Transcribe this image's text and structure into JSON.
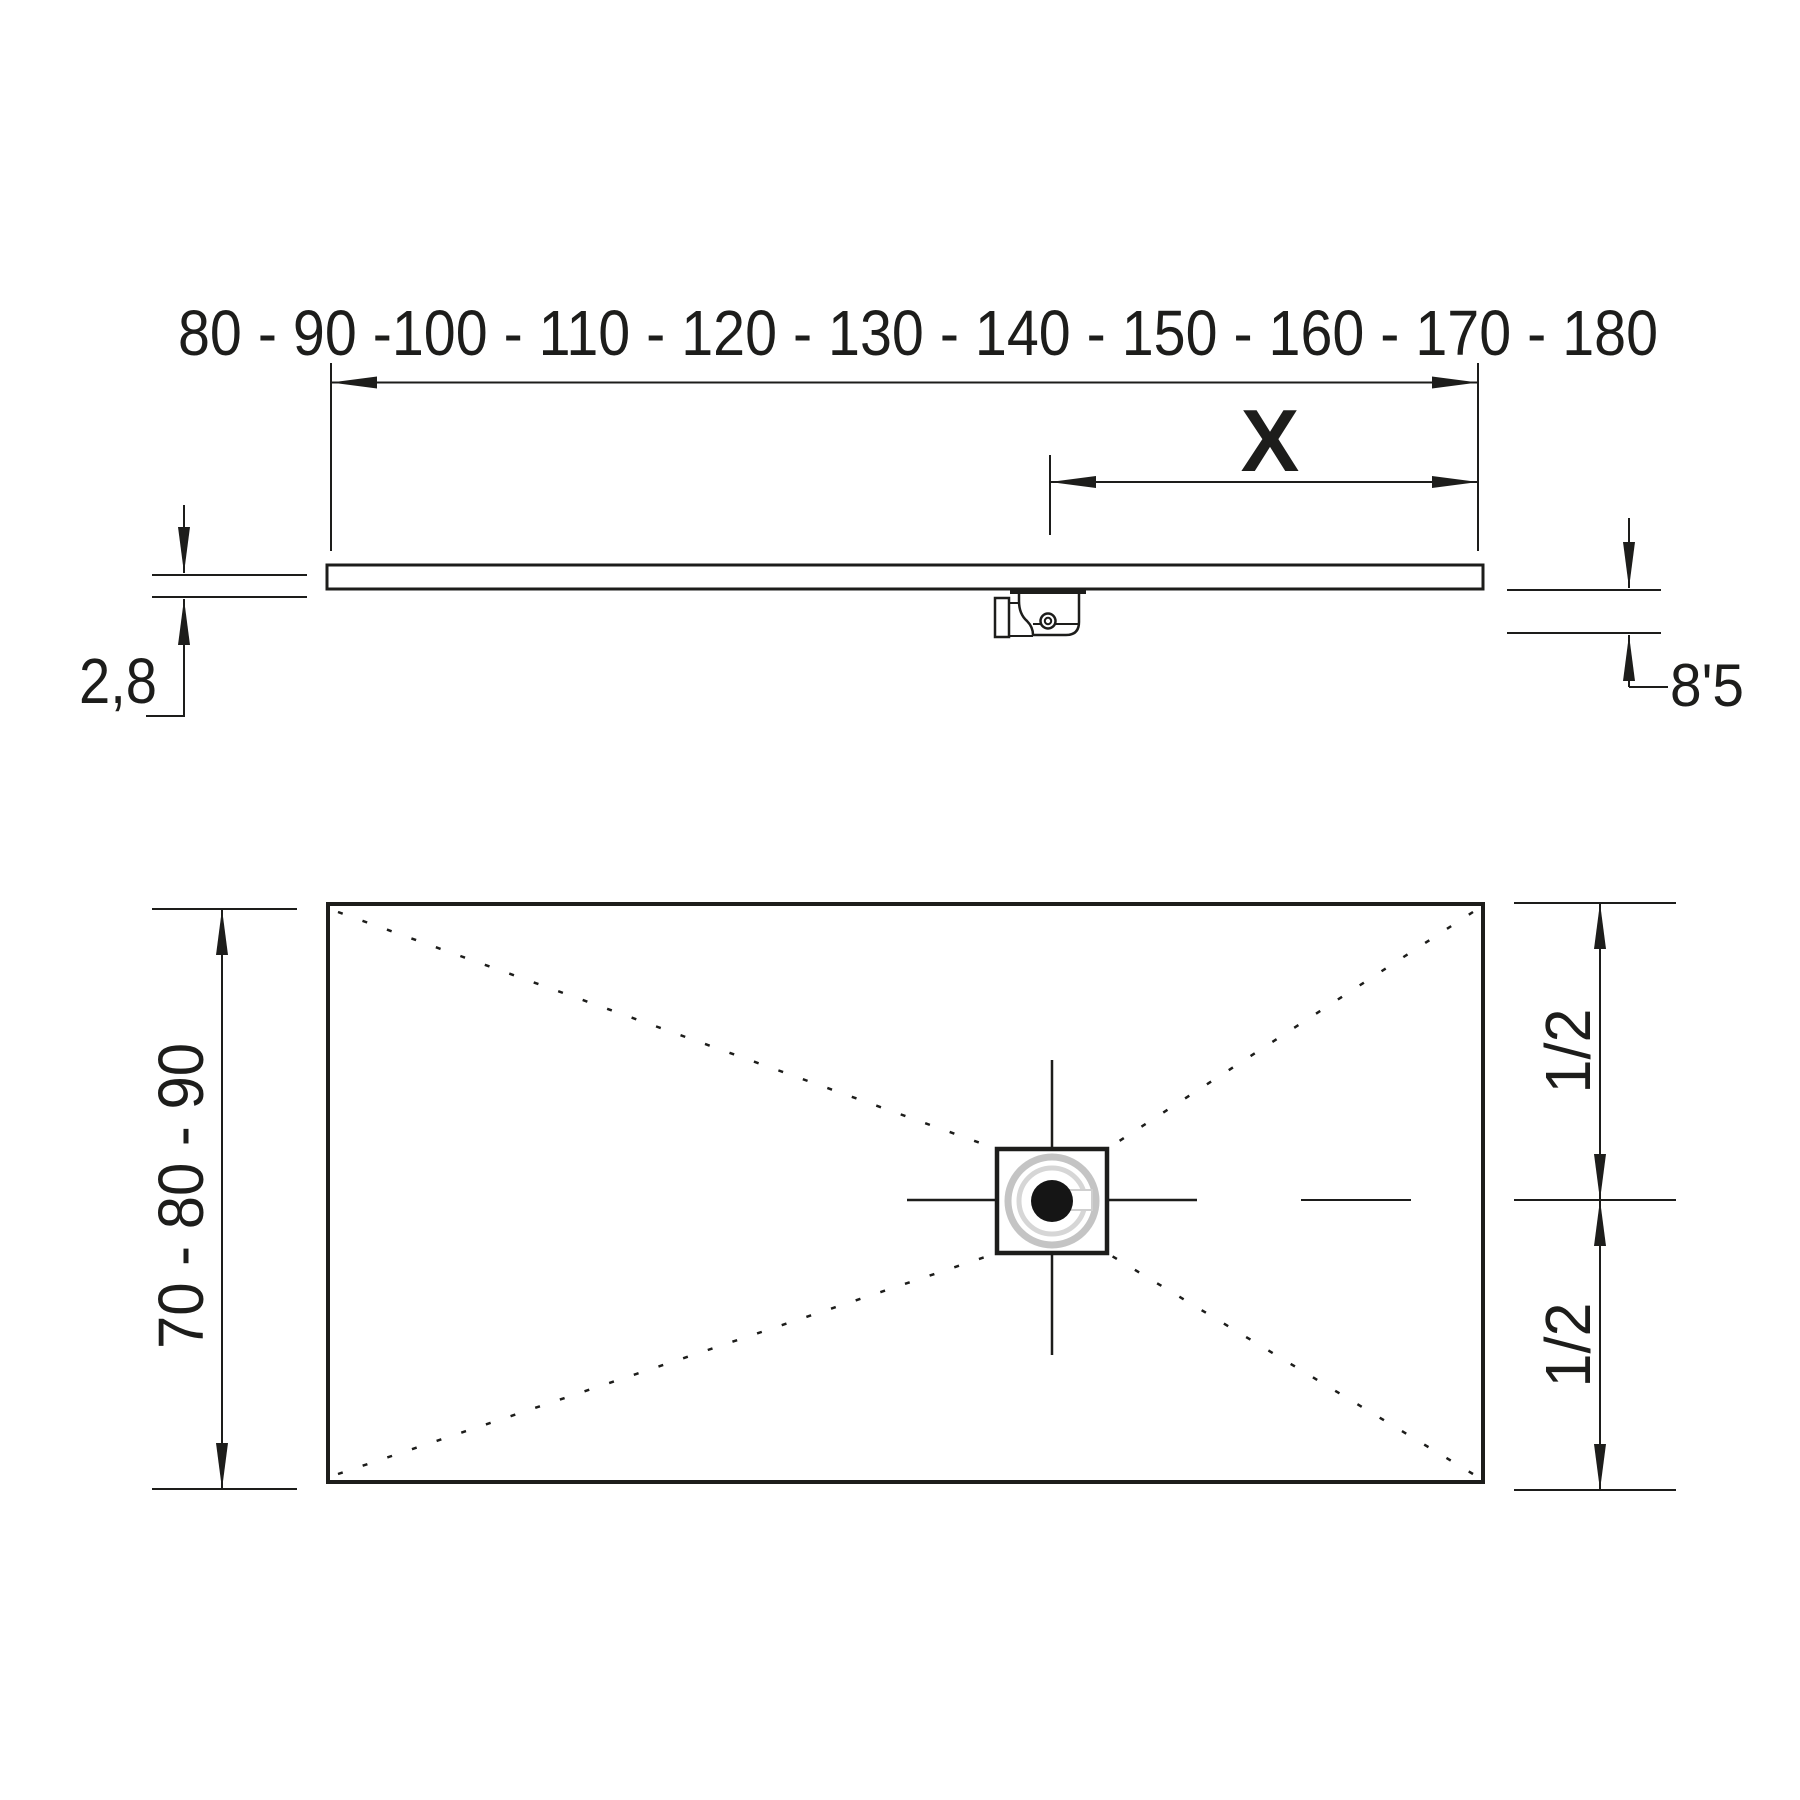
{
  "drawing": {
    "background": "#ffffff",
    "line_color": "#1d1d1b",
    "side_view": {
      "width_sizes_label": "80 - 90 -100 - 110 - 120 - 130 - 140 - 150 - 160 - 170 - 180",
      "x_dim_label": "X",
      "thickness_label": "2,8",
      "drain_height_label": "8'5"
    },
    "plan_view": {
      "depth_sizes_label": "70 - 80 - 90",
      "half_upper_label": "1/2",
      "half_lower_label": "1/2"
    }
  }
}
